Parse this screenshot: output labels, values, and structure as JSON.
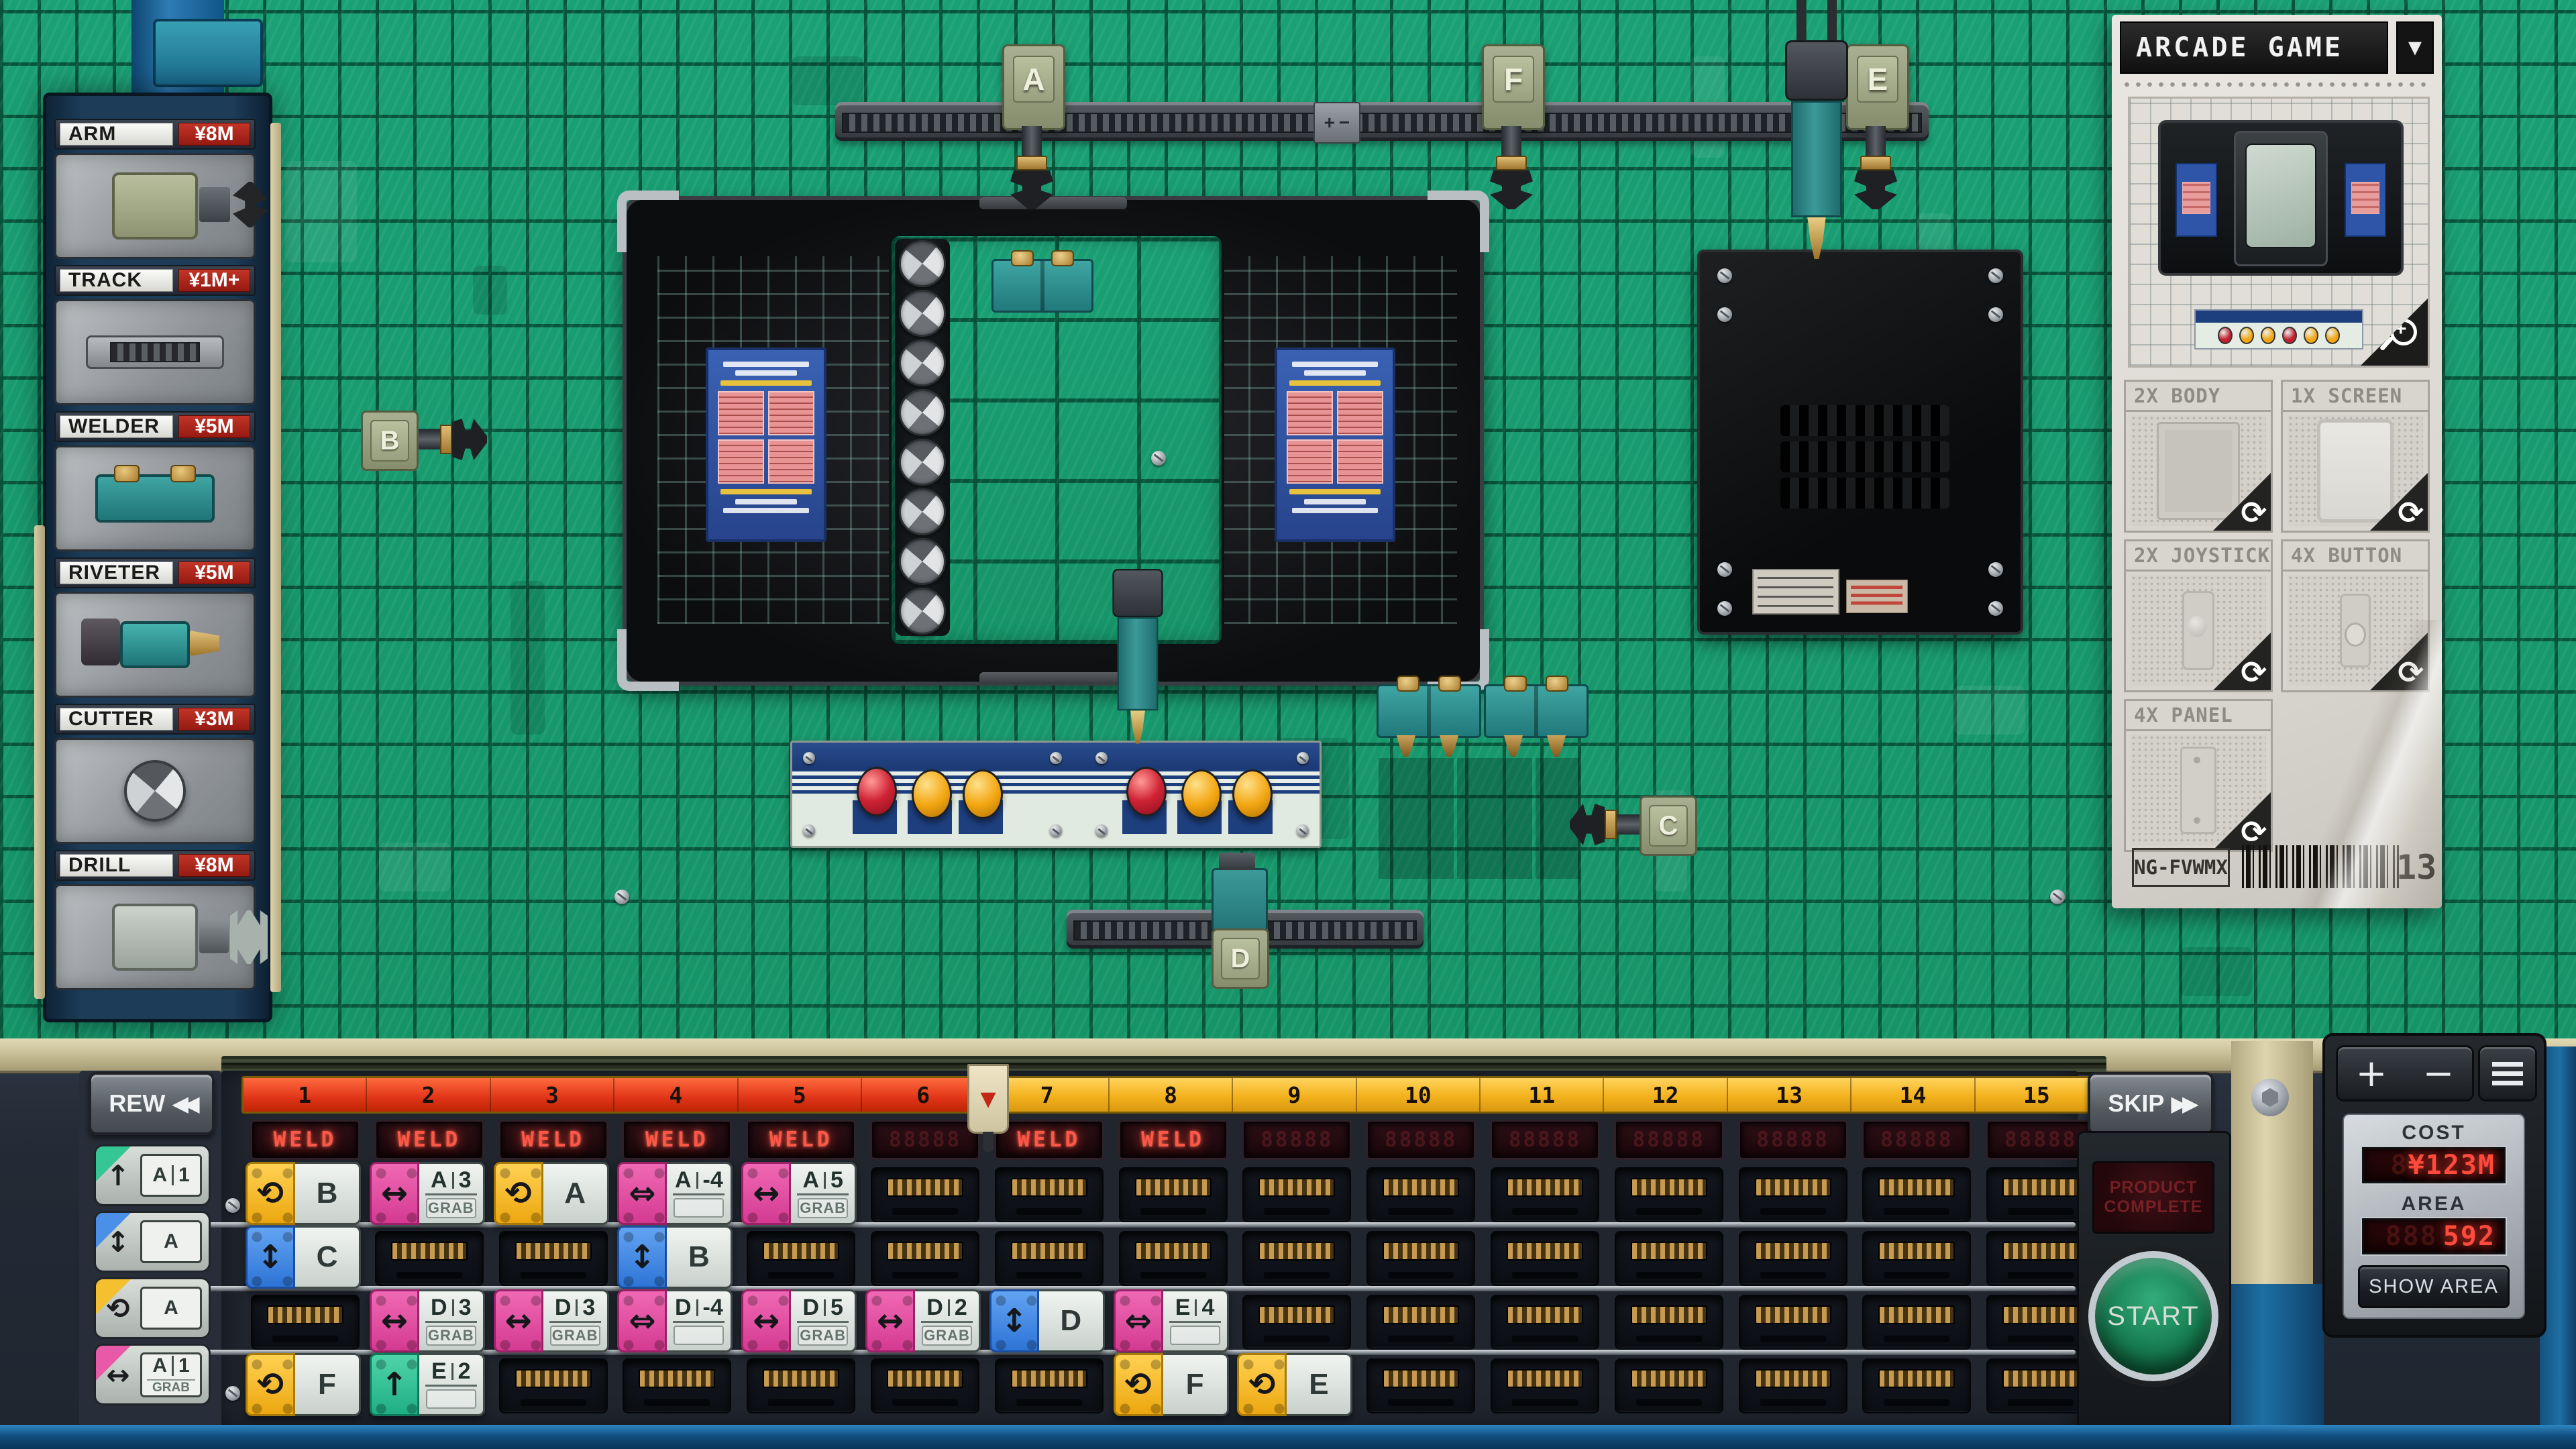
{
  "colors": {
    "floor_green": "#179a6d",
    "deck": "#272e3a",
    "ruler_yellow": "#f3b21d",
    "ruler_red": "#e03418",
    "led_red": "#ff5044",
    "price_red": "#9c1b12",
    "block_yellow": "#f2b21d",
    "block_pink": "#dd4397",
    "block_blue": "#3d86e8",
    "block_green": "#2cbf92",
    "teal_machine": "#2e8f8d"
  },
  "shop": {
    "items": [
      {
        "name": "ARM",
        "price": "¥8M",
        "icon": "arm"
      },
      {
        "name": "TRACK",
        "price": "¥1M+",
        "icon": "track"
      },
      {
        "name": "WELDER",
        "price": "¥5M",
        "icon": "weld"
      },
      {
        "name": "RIVETER",
        "price": "¥5M",
        "icon": "riv"
      },
      {
        "name": "CUTTER",
        "price": "¥3M",
        "icon": "cut"
      },
      {
        "name": "DRILL",
        "price": "¥8M",
        "icon": "drill"
      }
    ]
  },
  "order_card": {
    "title": "ARCADE GAME",
    "dropdown_icon": "▼",
    "parts": [
      {
        "label": "2X BODY",
        "icon": "body"
      },
      {
        "label": "1X SCREEN",
        "icon": "screen"
      },
      {
        "label": "2X JOYSTICK",
        "icon": "stick"
      },
      {
        "label": "4X BUTTON",
        "icon": "btn"
      },
      {
        "label": "4X PANEL",
        "icon": "panel"
      }
    ],
    "code": "NG-FVWMX",
    "queue_count": "13"
  },
  "floor": {
    "stations": [
      {
        "id": "A"
      },
      {
        "id": "B"
      },
      {
        "id": "C"
      },
      {
        "id": "D"
      },
      {
        "id": "E"
      },
      {
        "id": "F"
      }
    ]
  },
  "timeline": {
    "rew_label": "REW",
    "rew_icon": "◀◀",
    "skip_label": "SKIP",
    "skip_icon": "▶▶",
    "numbers": [
      "1",
      "2",
      "3",
      "4",
      "5",
      "6",
      "7",
      "8",
      "9",
      "10",
      "11",
      "12",
      "13",
      "14",
      "15"
    ],
    "elapsed_columns": 6,
    "playhead_icon": "▼",
    "led_ghost": "88888",
    "led_labels": [
      {
        "col": 1,
        "text": "WELD"
      },
      {
        "col": 2,
        "text": "WELD"
      },
      {
        "col": 3,
        "text": "WELD"
      },
      {
        "col": 4,
        "text": "WELD"
      },
      {
        "col": 5,
        "text": "WELD"
      },
      {
        "col": 7,
        "text": "WELD"
      },
      {
        "col": 8,
        "text": "WELD"
      }
    ]
  },
  "program": {
    "rows": [
      [
        {
          "col": 1,
          "kind": "rotate",
          "label": "B"
        },
        {
          "col": 2,
          "kind": "grab",
          "label": "A",
          "num": "3",
          "sub": "GRAB"
        },
        {
          "col": 3,
          "kind": "rotate",
          "label": "A"
        },
        {
          "col": 4,
          "kind": "shift",
          "label": "A",
          "num": "-4"
        },
        {
          "col": 5,
          "kind": "grab",
          "label": "A",
          "num": "5",
          "sub": "GRAB"
        }
      ],
      [
        {
          "col": 1,
          "kind": "vertical",
          "label": "C"
        },
        {
          "col": 4,
          "kind": "vertical",
          "label": "B"
        }
      ],
      [
        {
          "col": 2,
          "kind": "grab",
          "label": "D",
          "num": "3",
          "sub": "GRAB"
        },
        {
          "col": 3,
          "kind": "grab",
          "label": "D",
          "num": "3",
          "sub": "GRAB"
        },
        {
          "col": 4,
          "kind": "shift",
          "label": "D",
          "num": "-4"
        },
        {
          "col": 5,
          "kind": "grab",
          "label": "D",
          "num": "5",
          "sub": "GRAB"
        },
        {
          "col": 6,
          "kind": "grab",
          "label": "D",
          "num": "2",
          "sub": "GRAB"
        },
        {
          "col": 7,
          "kind": "vertical",
          "label": "D"
        },
        {
          "col": 8,
          "kind": "shift",
          "label": "E",
          "num": "4"
        }
      ],
      [
        {
          "col": 1,
          "kind": "rotate",
          "label": "F"
        },
        {
          "col": 2,
          "kind": "lift",
          "label": "E",
          "num": "2"
        },
        {
          "col": 8,
          "kind": "rotate",
          "label": "F"
        },
        {
          "col": 9,
          "kind": "rotate",
          "label": "E"
        }
      ]
    ]
  },
  "palette": [
    {
      "kind": "lift",
      "label": "A",
      "num": "1"
    },
    {
      "kind": "vertical",
      "label": "A"
    },
    {
      "kind": "rotate",
      "label": "A"
    },
    {
      "kind": "grab",
      "label": "A",
      "num": "1",
      "sub": "GRAB"
    }
  ],
  "console": {
    "plus": "+",
    "minus": "−",
    "menu_icon": "menu",
    "cost_label": "COST",
    "cost_ghost": "8",
    "cost_value": "¥123M",
    "area_label": "AREA",
    "area_ghost": "888",
    "area_value": "592",
    "show_area_label": "SHOW AREA",
    "start_label": "START",
    "complete_label": "PRODUCT COMPLETE"
  }
}
